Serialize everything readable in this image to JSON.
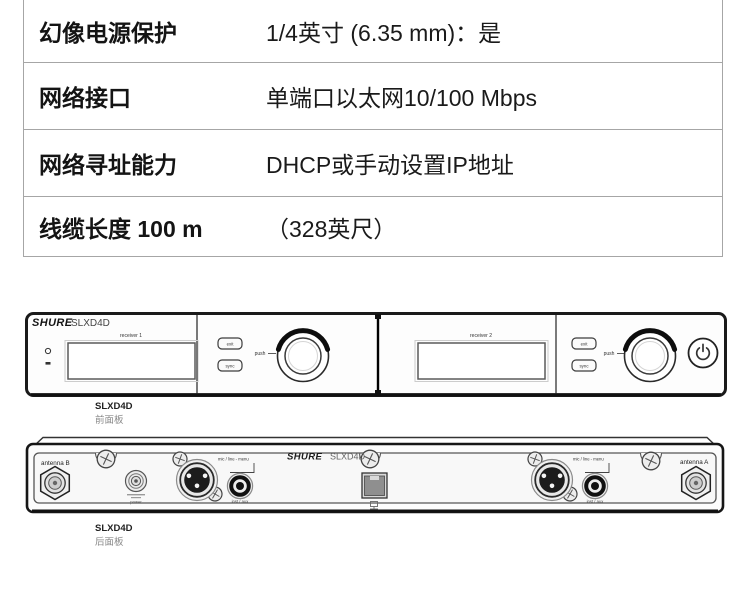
{
  "spec_table": {
    "rows": [
      {
        "label": "幻像电源保护",
        "value": "1/4英寸 (6.35 mm)：是"
      },
      {
        "label": "网络接口",
        "value": "单端口以太网10/100 Mbps"
      },
      {
        "label": "网络寻址能力",
        "value": "DHCP或手动设置IP地址"
      },
      {
        "label": "线缆长度 100 m",
        "value": "（328英尺）"
      }
    ]
  },
  "front_panel": {
    "brand": "SHURE",
    "model": "SLXD4D",
    "receiver_1_label": "receiver 1",
    "receiver_2_label": "receiver 2",
    "exit_label": "exit",
    "sync_label": "sync",
    "push_label": "push",
    "caption_model": "SLXD4D",
    "caption_text": "前面板"
  },
  "rear_panel": {
    "brand": "SHURE",
    "model": "SLXD4D",
    "antenna_b_label": "antenna B",
    "antenna_a_label": "antenna A",
    "power_label": "power",
    "xlr_label": "mic / line - menu",
    "aux_label": "inst / aux",
    "caption_model": "SLXD4D",
    "caption_text": "后面板"
  },
  "colors": {
    "table_border": "#a6a6a6",
    "ink": "#111111",
    "panel_outline": "#1a1a1a",
    "muted_text": "#777777"
  }
}
